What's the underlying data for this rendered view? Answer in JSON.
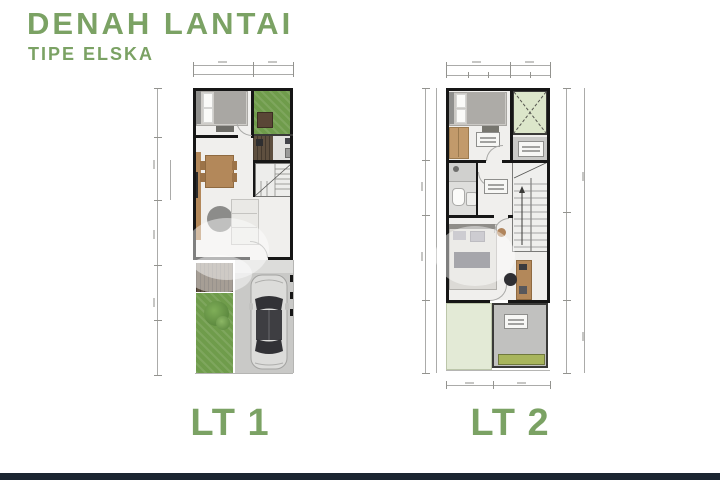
{
  "header": {
    "title": "DENAH LANTAI",
    "subtitle": "TIPE ELSKA"
  },
  "plans": [
    {
      "label": "LT 1"
    },
    {
      "label": "LT 2"
    }
  ],
  "palette": {
    "accent_green": "#7BA264",
    "wall_black": "#161616",
    "floor_light": "#F0EFED",
    "grass_green": "#6F9C4B",
    "pale_green": "#DCE6CA",
    "deck_brown": "#5E4F3F",
    "wood": "#B3885A",
    "concrete_gray": "#C9C9C7",
    "car_silver": "#DCDCDA",
    "footer_navy": "#1B2531"
  }
}
